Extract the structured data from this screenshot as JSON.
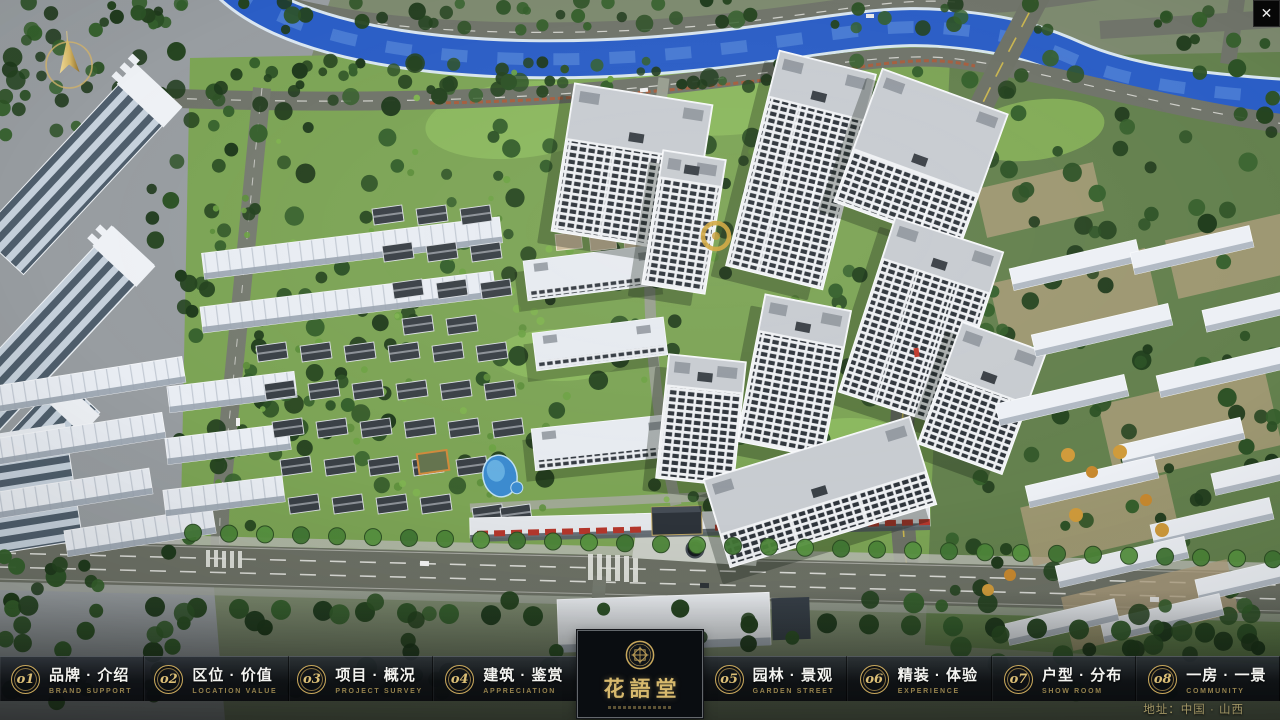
{
  "window": {
    "close": "✕"
  },
  "brand": {
    "accent_gold": "#c9a85c",
    "nav_background": "#0d1117"
  },
  "nav": {
    "items": [
      {
        "num": "o1",
        "zh": "品牌 · 介绍",
        "en": "BRAND SUPPORT"
      },
      {
        "num": "o2",
        "zh": "区位 · 价值",
        "en": "LOCATION VALUE"
      },
      {
        "num": "o3",
        "zh": "项目 · 概况",
        "en": "PROJECT SURVEY"
      },
      {
        "num": "o4",
        "zh": "建筑 · 鉴赏",
        "en": "APPRECIATION"
      },
      {
        "num": "o5",
        "zh": "园林 · 景观",
        "en": "GARDEN STREET"
      },
      {
        "num": "o6",
        "zh": "精装 · 体验",
        "en": "EXPERIENCE"
      },
      {
        "num": "o7",
        "zh": "户型 · 分布",
        "en": "SHOW ROOM"
      },
      {
        "num": "o8",
        "zh": "一房 · 一景",
        "en": "COMMUNITY"
      }
    ]
  },
  "logo": {
    "title": "花語堂"
  },
  "footer": {
    "address": "地址：中国 · 山西"
  }
}
